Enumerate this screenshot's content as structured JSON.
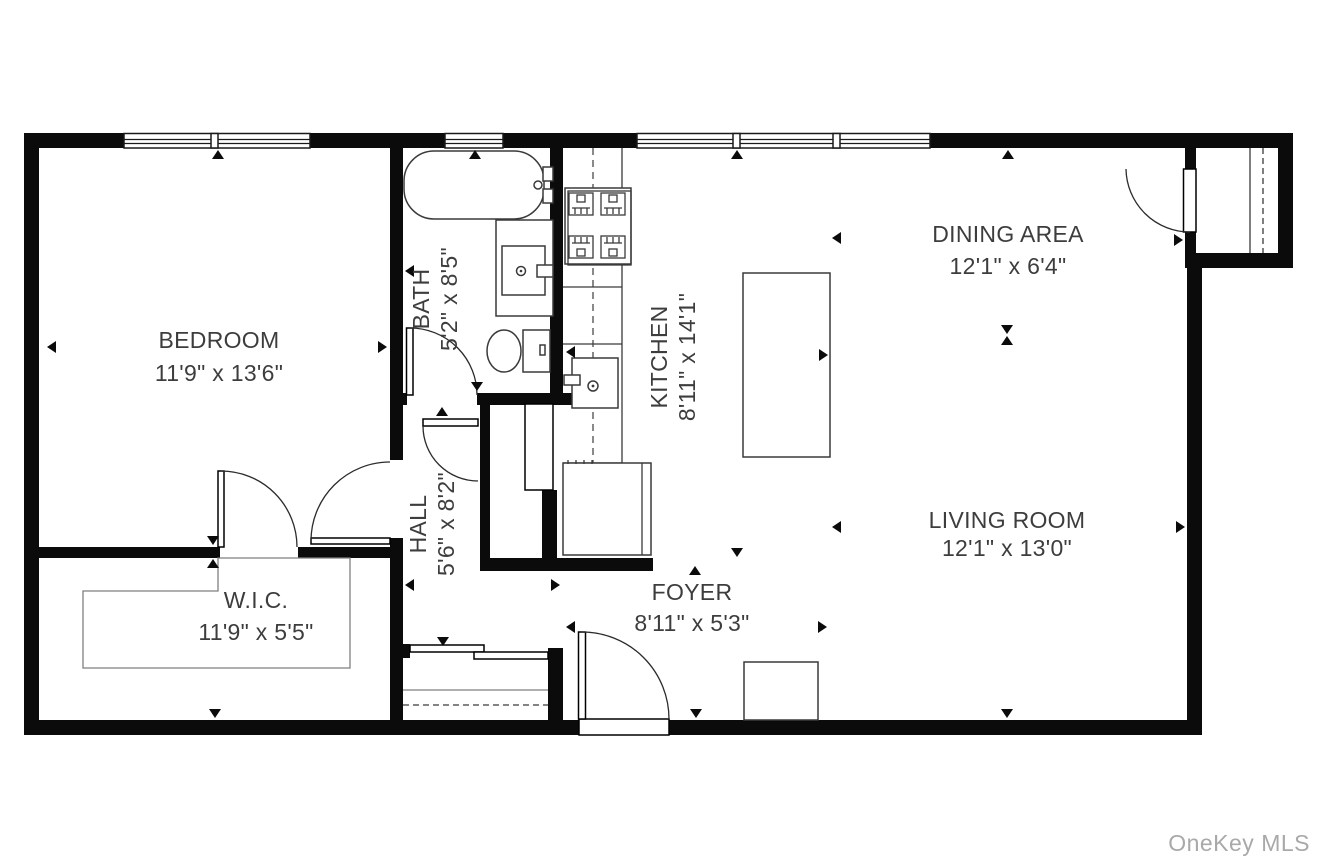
{
  "plan": {
    "watermark": "OneKey MLS",
    "rooms": {
      "bedroom": {
        "name": "BEDROOM",
        "dims": "11'9\" x 13'6\""
      },
      "bath": {
        "name": "BATH",
        "dims": "5'2\" x 8'5\""
      },
      "kitchen": {
        "name": "KITCHEN",
        "dims": "8'11\" x 14'1\""
      },
      "dining": {
        "name": "DINING AREA",
        "dims": "12'1\" x 6'4\""
      },
      "living": {
        "name": "LIVING ROOM",
        "dims": "12'1\" x 13'0\""
      },
      "hall": {
        "name": "HALL",
        "dims": "5'6\" x 8'2\""
      },
      "wic": {
        "name": "W.I.C.",
        "dims": "11'9\" x 5'5\""
      },
      "foyer": {
        "name": "FOYER",
        "dims": "8'11\" x 5'3\""
      }
    },
    "colors": {
      "wall": "#0b0b0b",
      "fixture_stroke": "#3a3a3a",
      "thin_outline": "#7f7f7f",
      "label_text": "#3d3d3d",
      "watermark": "#a9a9a9",
      "background": "#ffffff"
    },
    "fixtures": [
      "bathtub",
      "vanity-sink",
      "toilet",
      "stove",
      "kitchen-sink",
      "refrigerator",
      "kitchen-island",
      "walk-in-closet-outline",
      "sliding-door-closet",
      "entry-closet",
      "foyer-cabinet"
    ]
  }
}
